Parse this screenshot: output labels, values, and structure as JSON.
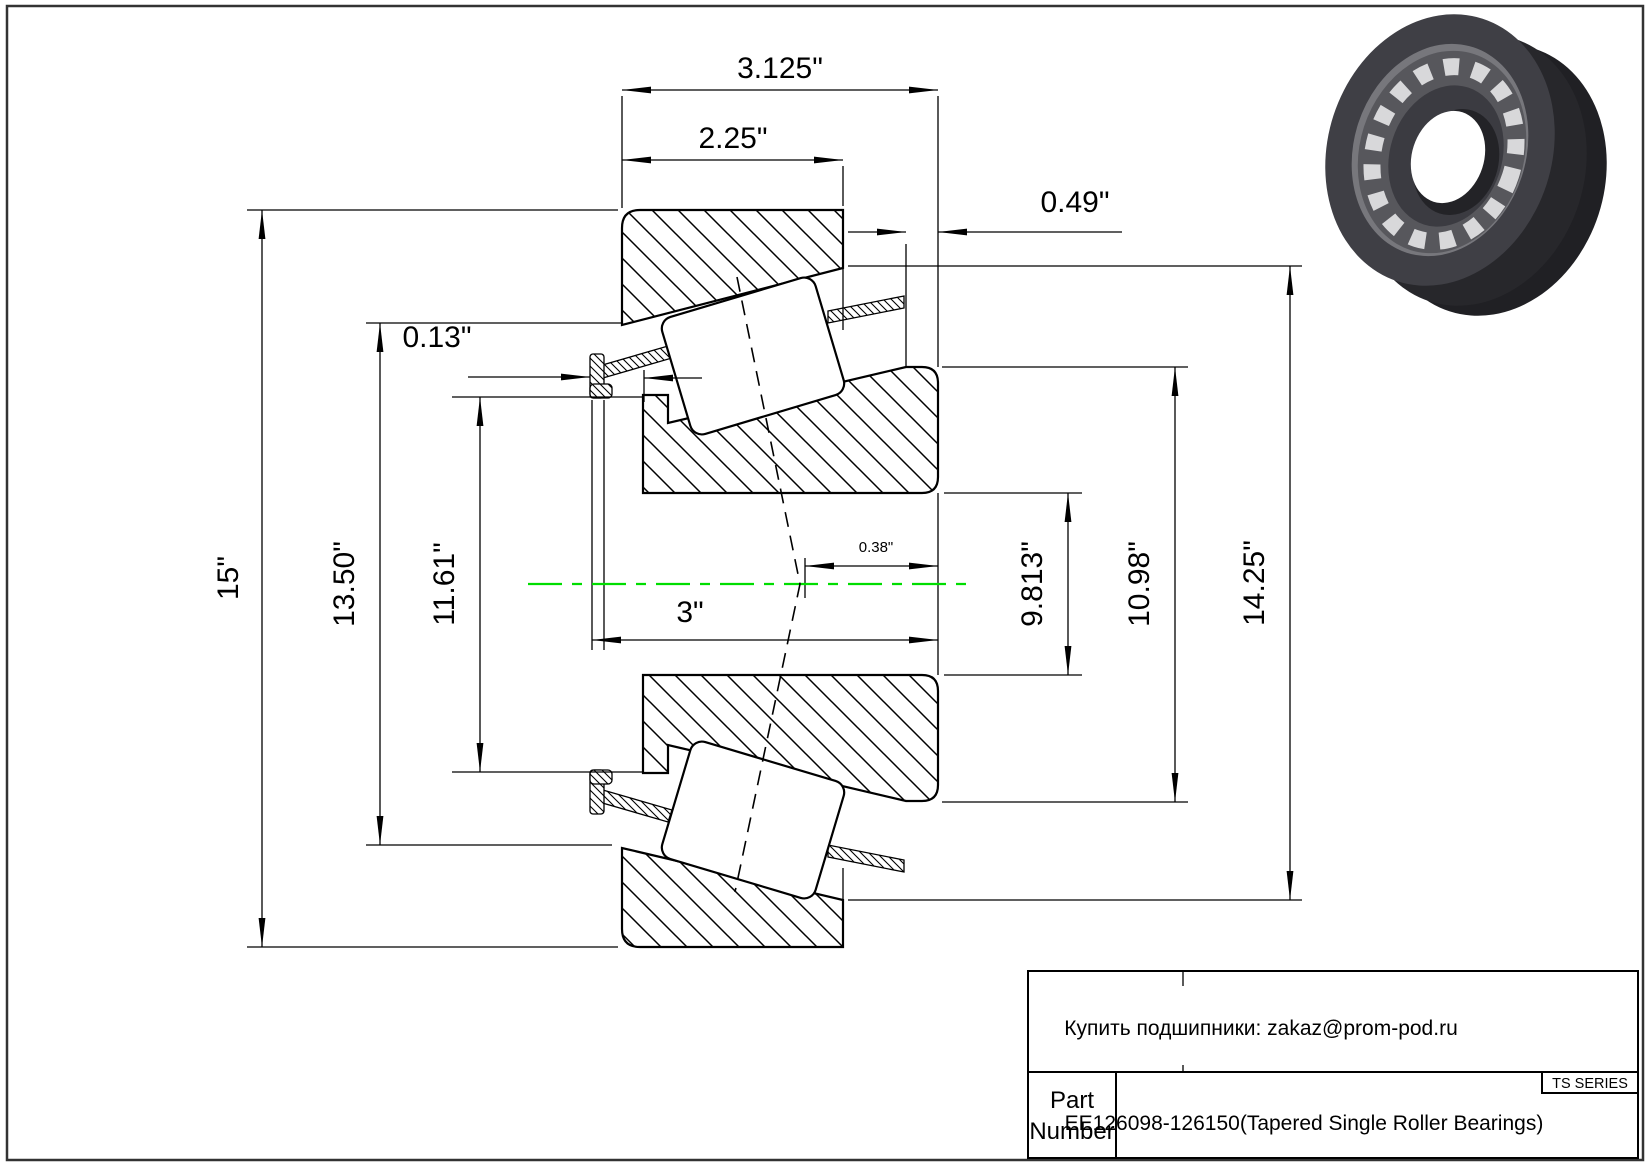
{
  "drawing": {
    "kind": "tapered-roller-bearing-cross-section",
    "centerline_color": "#00dd00",
    "line_color": "#000000",
    "bearing_render_color": "#3f3f45"
  },
  "dims": {
    "d3125": "3.125\"",
    "d225": "2.25\"",
    "d049": "0.49\"",
    "d013": "0.13\"",
    "d15": "15\"",
    "d1350": "13.50\"",
    "d1161": "11.61\"",
    "d3": "3\"",
    "d038": "0.38\"",
    "d9813": "9.813\"",
    "d1098": "10.98\"",
    "d1425": "14.25\""
  },
  "title_block": {
    "supplier_note": "Купить подшипники: zakaz@prom-pod.ru",
    "series": "TS SERIES",
    "part_label_line1": "Part",
    "part_label_line2": "Number",
    "part_number": "EE126098-126150(Tapered Single Roller Bearings)"
  },
  "icons": {
    "bearing_photo": "bearing-3d-render"
  }
}
